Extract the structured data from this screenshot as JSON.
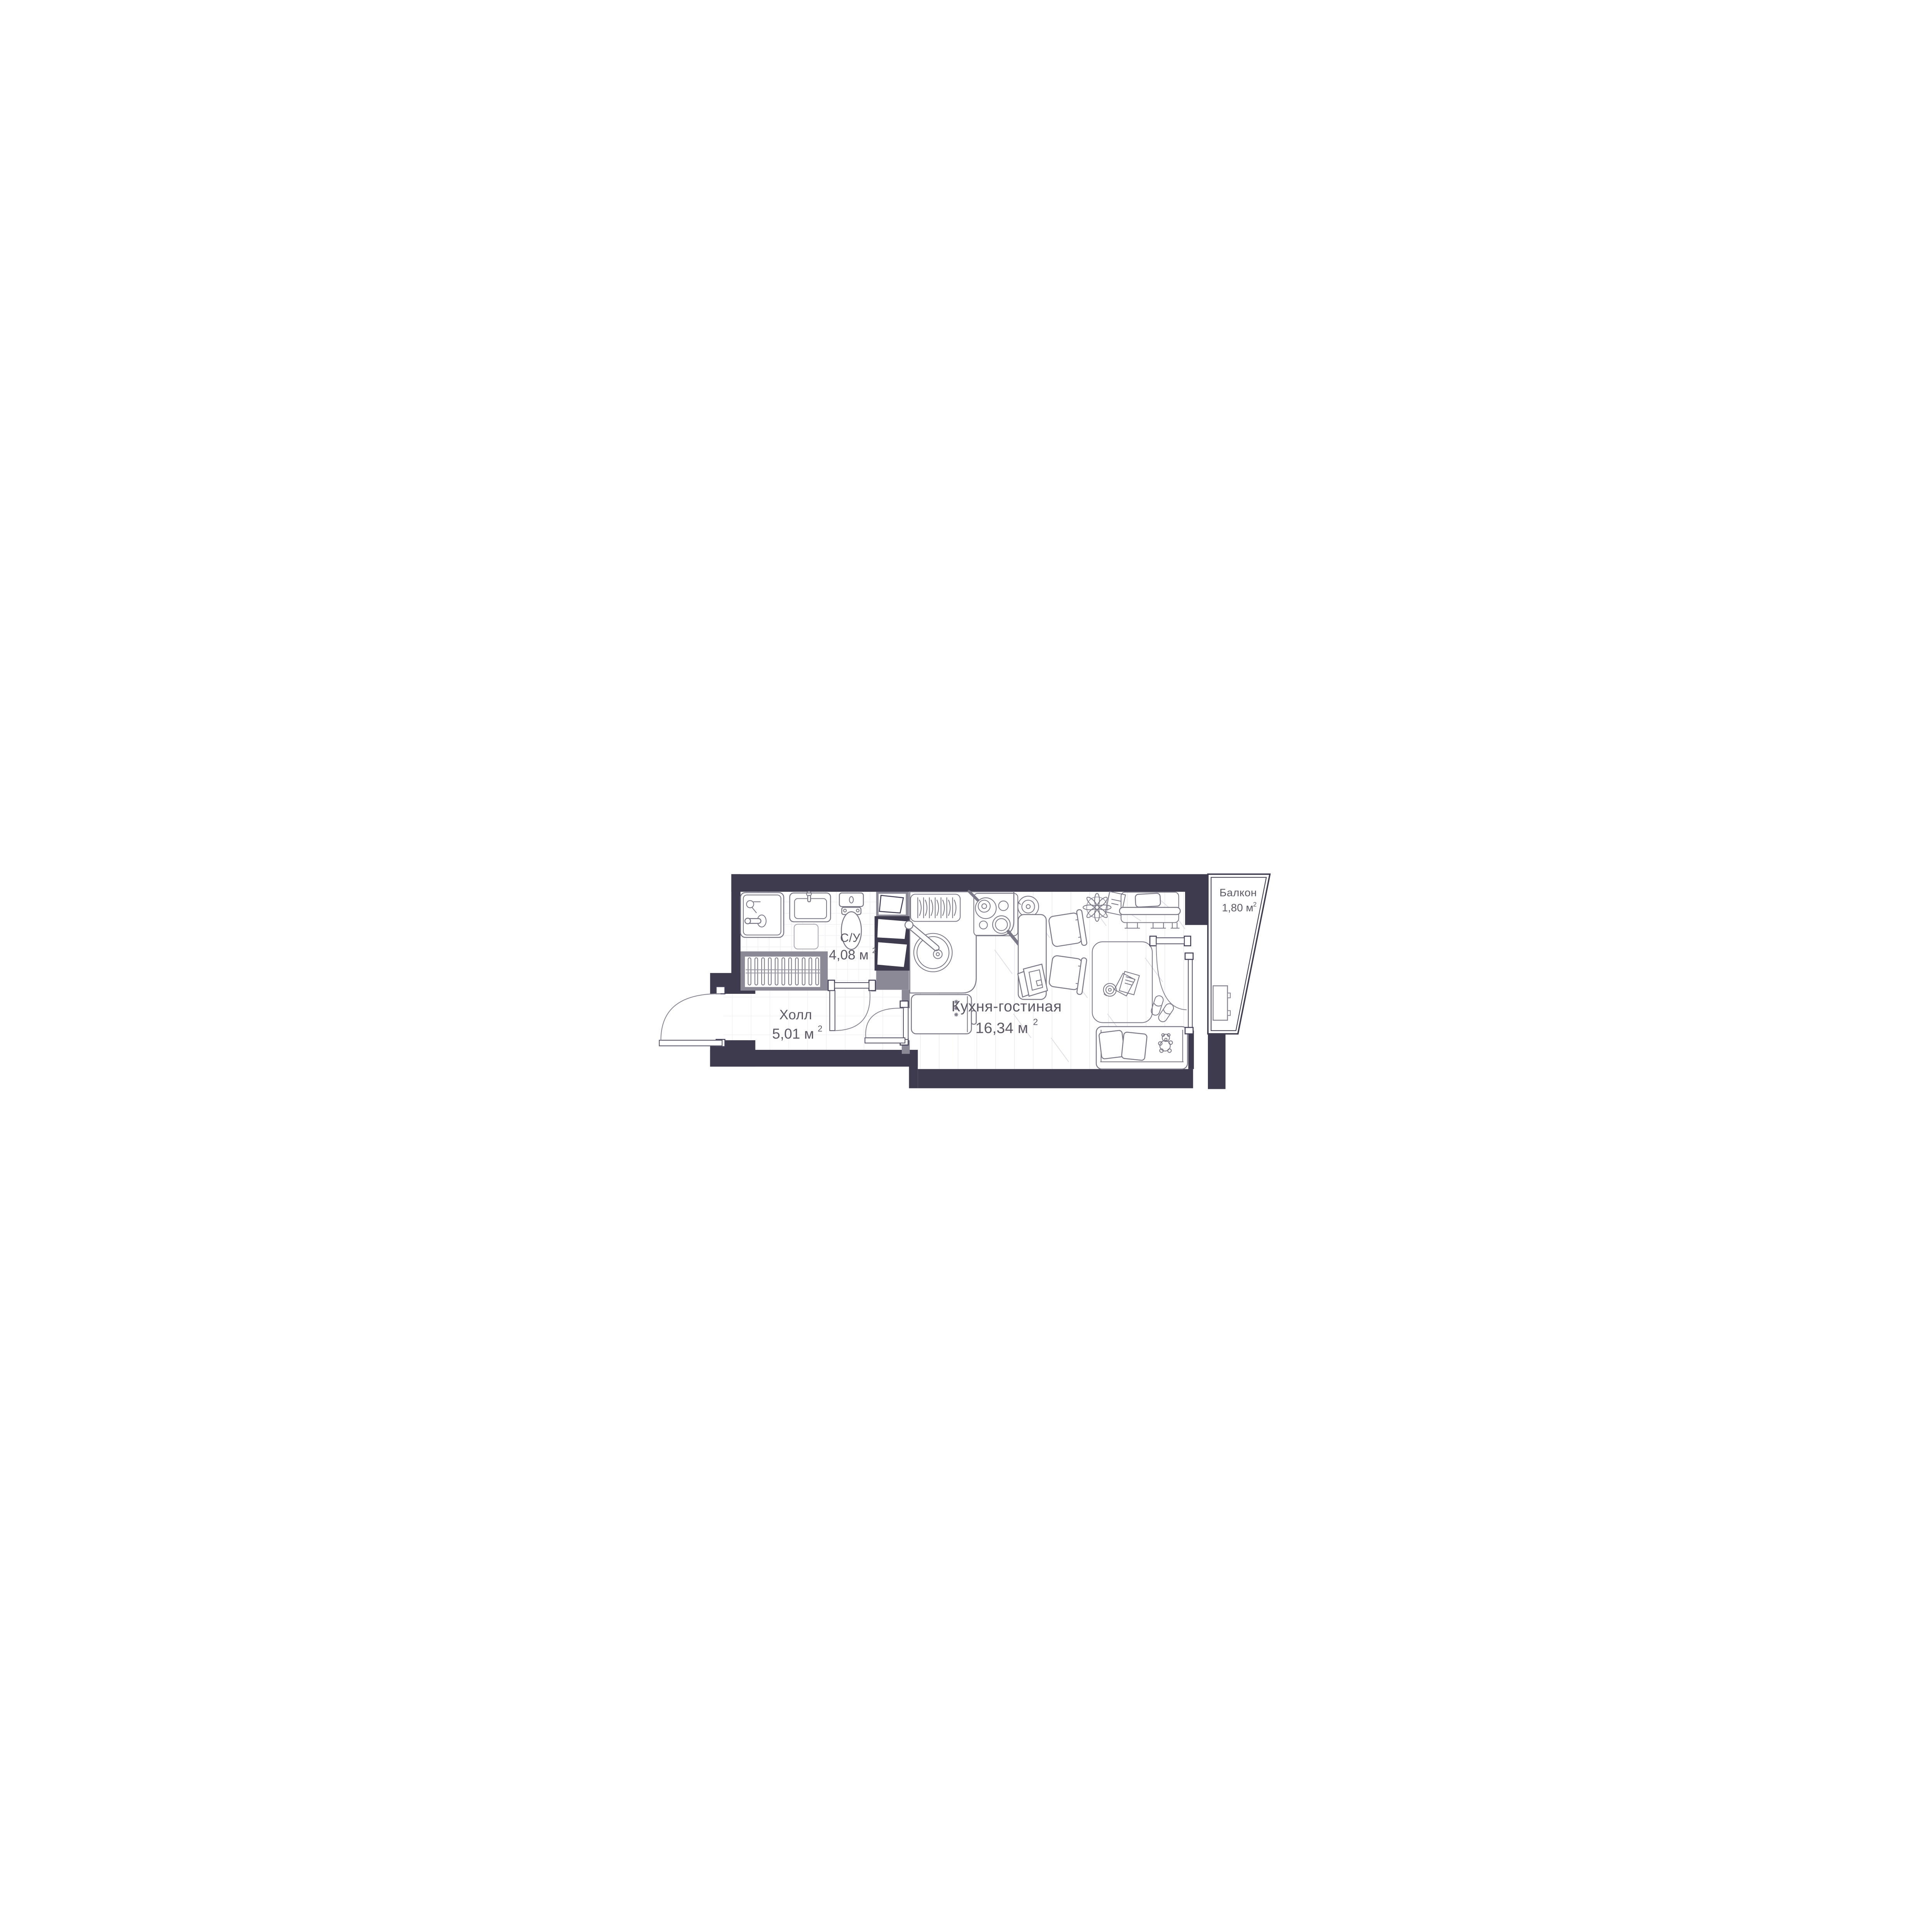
{
  "plan": {
    "title": "Studio apartment floor plan",
    "rooms": [
      {
        "id": "bathroom",
        "name": "С/У",
        "area": "4,08 м²",
        "area_value": "4,08 м",
        "area_sup": "2"
      },
      {
        "id": "hall",
        "name": "Холл",
        "area": "5,01 м²",
        "area_value": "5,01 м",
        "area_sup": "2"
      },
      {
        "id": "kitchen_living",
        "name": "Кухня-гостиная",
        "area": "16,34 м²",
        "area_value": "16,34 м",
        "area_sup": "2"
      },
      {
        "id": "balcony",
        "name": "Балкон",
        "area": "1,80 м²",
        "area_value": "1,80 м",
        "area_sup": "2"
      }
    ],
    "fixtures": [
      "bathtub-icon",
      "shower-head-icon",
      "bath-faucet-icon",
      "washbasin-icon",
      "bath-mat-icon",
      "toilet-icon",
      "wardrobe-hangers-icon",
      "laundry-shaft-icon",
      "dish-rack-icon",
      "kitchen-sink-icon",
      "stove-icon",
      "frying-pan-icon",
      "pot-icon",
      "fridge-icon",
      "freezer-stars-icon",
      "dining-table-icon",
      "laptop-icon",
      "chair-icon",
      "plant-icon",
      "paper-icon",
      "bed-icon",
      "pillow-icon",
      "rug-icon",
      "record-player-icon",
      "magazine-icon",
      "slippers-icon",
      "sofa-icon",
      "teddy-bear-icon",
      "balcony-window-box-icon",
      "entrance-door-icon",
      "bathroom-door-icon",
      "living-door-icon",
      "balcony-door-icon",
      "glazing-icon"
    ],
    "counts": {
      "wardrobe_hangers": 11,
      "dish_rack_plates": 7,
      "freezer_stars": 3
    },
    "colors": {
      "wall": "#3f3b4e",
      "wall_light": "#8c8996",
      "line": "#7b7887",
      "line_light": "#a9a7b4",
      "tile": "#ececf1",
      "plank": "#e4e3e9",
      "text": "#5c5965",
      "arc": "#8a8794",
      "background": "#ffffff"
    }
  }
}
